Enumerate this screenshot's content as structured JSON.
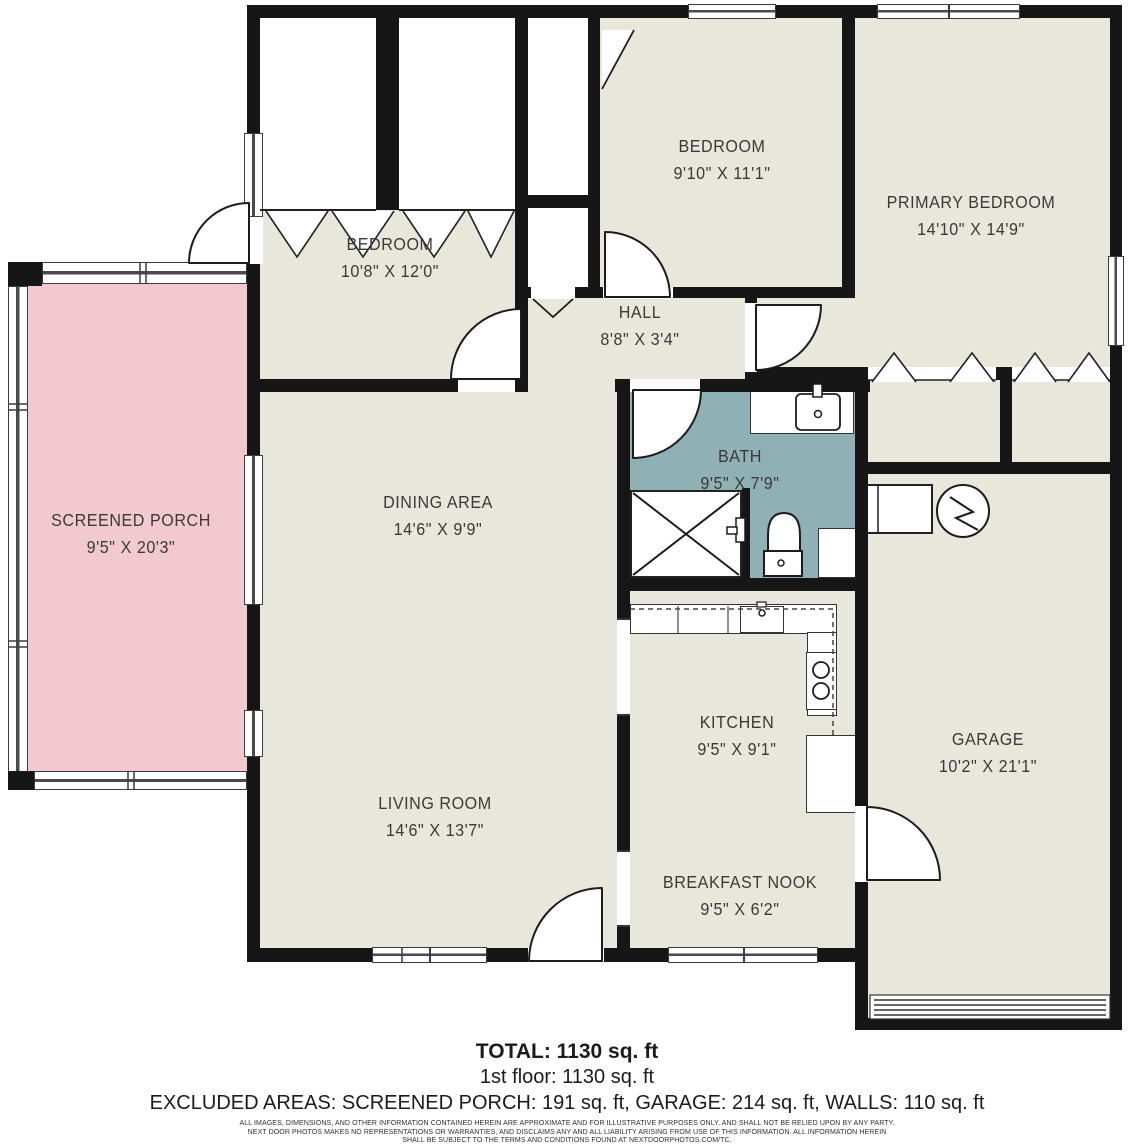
{
  "colors": {
    "wall": "#161616",
    "floor": "#e9e6db",
    "screened_porch_fill": "#f2c9ce",
    "bath_fill": "#8fb0b5",
    "label_text": "#3a3a3a"
  },
  "rooms": {
    "bedroom1": {
      "name": "BEDROOM",
      "dims": "10'8\" X 12'0\""
    },
    "bedroom2": {
      "name": "BEDROOM",
      "dims": "9'10\" X 11'1\""
    },
    "primary_bedroom": {
      "name": "PRIMARY BEDROOM",
      "dims": "14'10\" X 14'9\""
    },
    "hall": {
      "name": "HALL",
      "dims": "8'8\" X 3'4\""
    },
    "bath": {
      "name": "BATH",
      "dims": "9'5\" X 7'9\""
    },
    "dining_area": {
      "name": "DINING AREA",
      "dims": "14'6\" X 9'9\""
    },
    "kitchen": {
      "name": "KITCHEN",
      "dims": "9'5\" X 9'1\""
    },
    "living_room": {
      "name": "LIVING ROOM",
      "dims": "14'6\" X 13'7\""
    },
    "breakfast_nook": {
      "name": "BREAKFAST NOOK",
      "dims": "9'5\" X 6'2\""
    },
    "garage": {
      "name": "GARAGE",
      "dims": "10'2\" X 21'1\""
    },
    "screened_porch": {
      "name": "SCREENED PORCH",
      "dims": "9'5\" X 20'3\""
    }
  },
  "fixtures": [
    "bathroom-sink",
    "toilet",
    "shower",
    "kitchen-sink",
    "stove",
    "kitchen-counter",
    "water-heater",
    "washer",
    "garage-door",
    "closet-bifold-doors"
  ],
  "summary": {
    "total": "TOTAL: 1130 sq. ft",
    "first_floor": "1st floor: 1130 sq. ft",
    "excluded": "EXCLUDED AREAS: SCREENED PORCH: 191 sq. ft, GARAGE: 214 sq. ft, WALLS: 110 sq. ft"
  },
  "disclaimer": {
    "line1": "ALL IMAGES, DIMENSIONS, AND OTHER INFORMATION CONTAINED HEREIN ARE APPROXIMATE AND FOR ILLUSTRATIVE PURPOSES ONLY, AND SHALL NOT BE RELIED UPON BY ANY PARTY.",
    "line2": "NEXT DOOR PHOTOS MAKES NO REPRESENTATIONS OR WARRANTIES, AND DISCLAIMS ANY AND ALL LIABILITY ARISING FROM USE OF THIS INFORMATION. ALL INFORMATION HEREIN",
    "line3": "SHALL BE SUBJECT TO THE TERMS AND CONDITIONS FOUND AT NEXTDOORPHOTOS.COM/TC."
  }
}
